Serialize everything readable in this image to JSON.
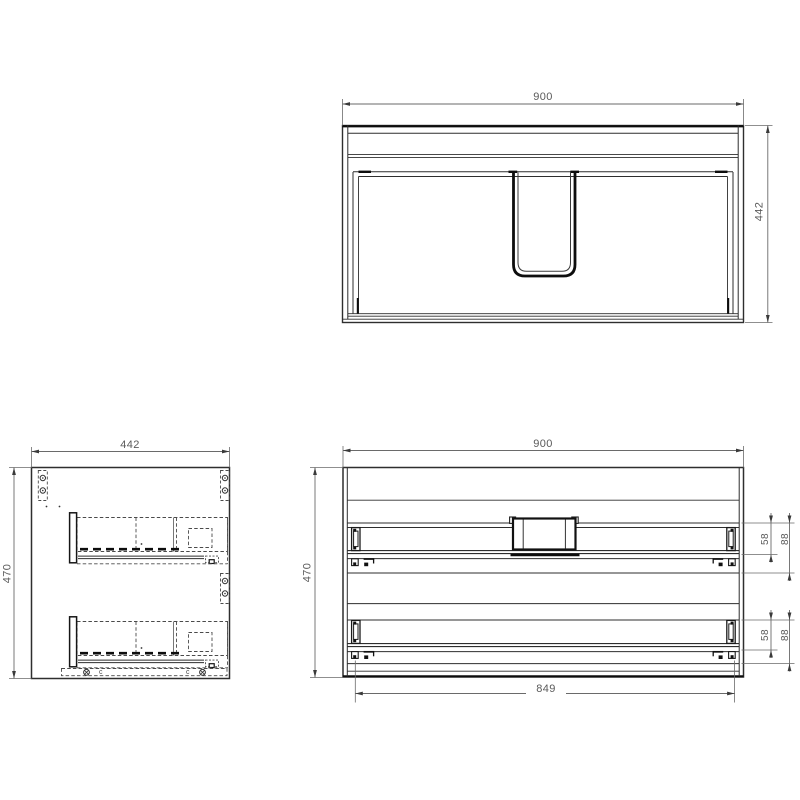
{
  "title": "Cabinet technical drawing - three orthographic views",
  "views": {
    "top": {
      "name": "top view",
      "width_mm": "900",
      "depth_mm": "442"
    },
    "side": {
      "name": "side view",
      "width_mm": "442",
      "height_mm": "470",
      "marker_left": "c",
      "marker_right": "c"
    },
    "front": {
      "name": "front view",
      "width_mm": "900",
      "height_mm": "470",
      "slide_span_mm": "849",
      "upper_slide": {
        "rail_mm": "58",
        "clearance_mm": "88"
      },
      "lower_slide": {
        "rail_mm": "58",
        "clearance_mm": "88"
      }
    }
  },
  "colors": {
    "background": "#ffffff",
    "object_line": "#2e2e2e",
    "heavy_line": "#0d0d0d",
    "dim_line": "#6a6a6a",
    "dim_text": "#5a5a5a",
    "hardware_dashed": "#4a4a4a"
  }
}
